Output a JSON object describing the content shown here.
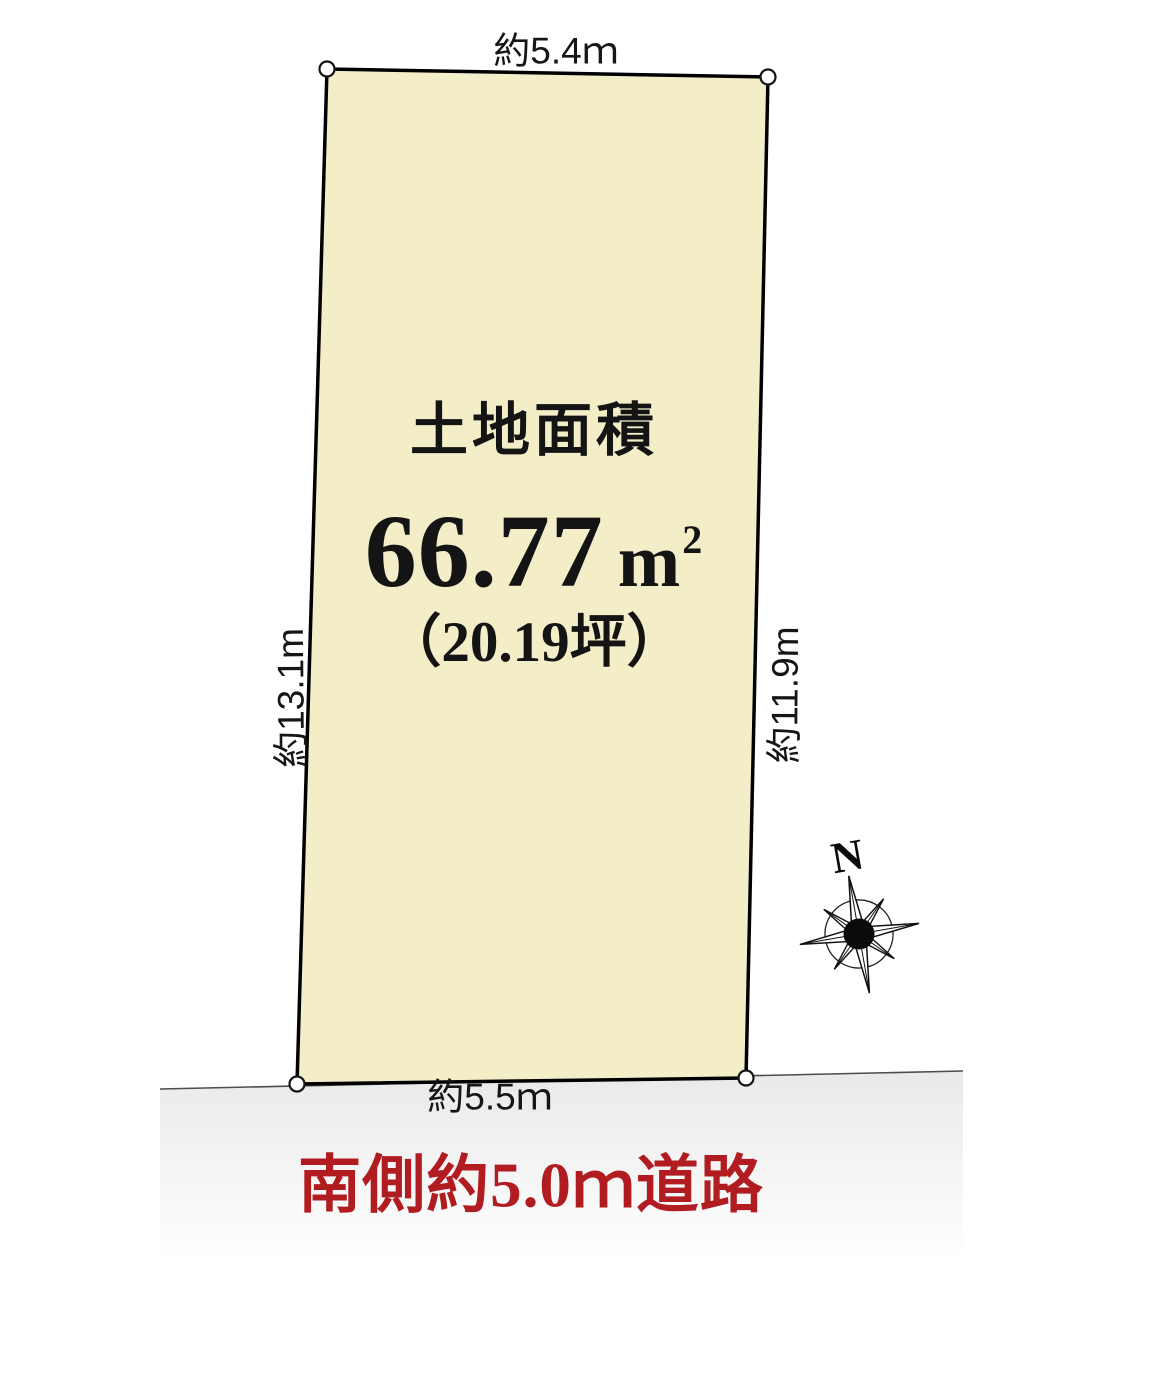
{
  "plot": {
    "fill_color": "#f3edc8",
    "area_title": "土地面積",
    "area_value": "66.77",
    "area_unit_base": "m",
    "area_unit_sup": "2",
    "area_tsubo": "（20.19坪）"
  },
  "dimensions": {
    "top": "約5.4ｍ",
    "left": "約13.1m",
    "right": "約11.9m",
    "bottom": "約5.5ｍ"
  },
  "road": {
    "label": "南側約5.0ｍ道路",
    "label_color": "#b11c21"
  },
  "compass": {
    "north": "N"
  }
}
